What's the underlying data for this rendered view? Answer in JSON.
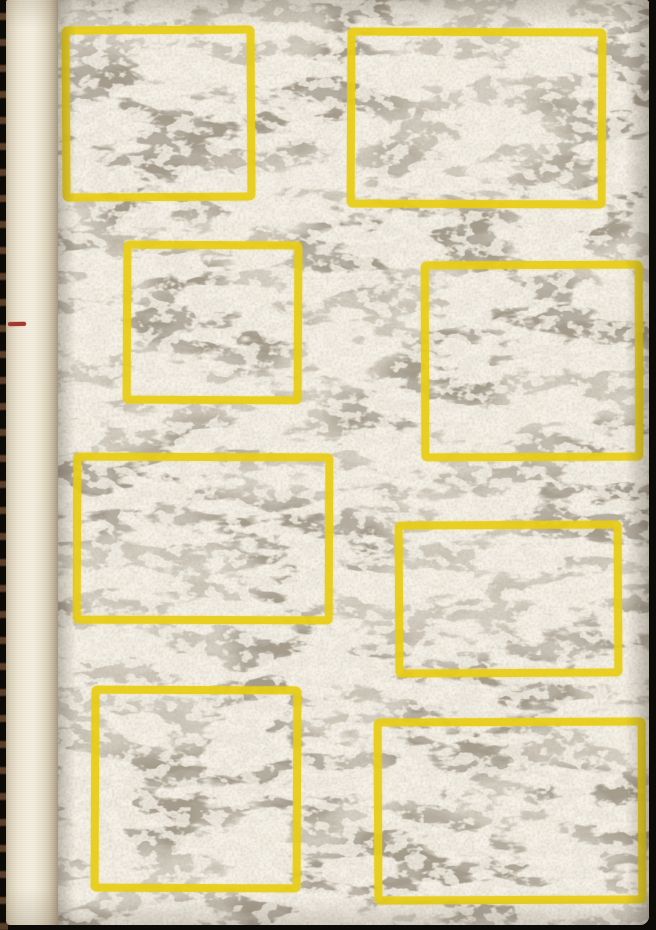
{
  "artwork": {
    "label": "Hardcover book with abstract sponged-texture cover and eight printed yellow rectangle outlines",
    "rectangles_count": 8,
    "colors": {
      "photo_background": "#0d0b08",
      "cover_gray": "#a59c8c",
      "texture_cream": "#e6dbc5",
      "texture_cream_light": "#efe5cf",
      "accent_yellow": "#e8cd13",
      "spine_light": "#f3edde",
      "spine_dark": "#d9cfb9",
      "spine_mark_red": "#a23a2f"
    }
  }
}
